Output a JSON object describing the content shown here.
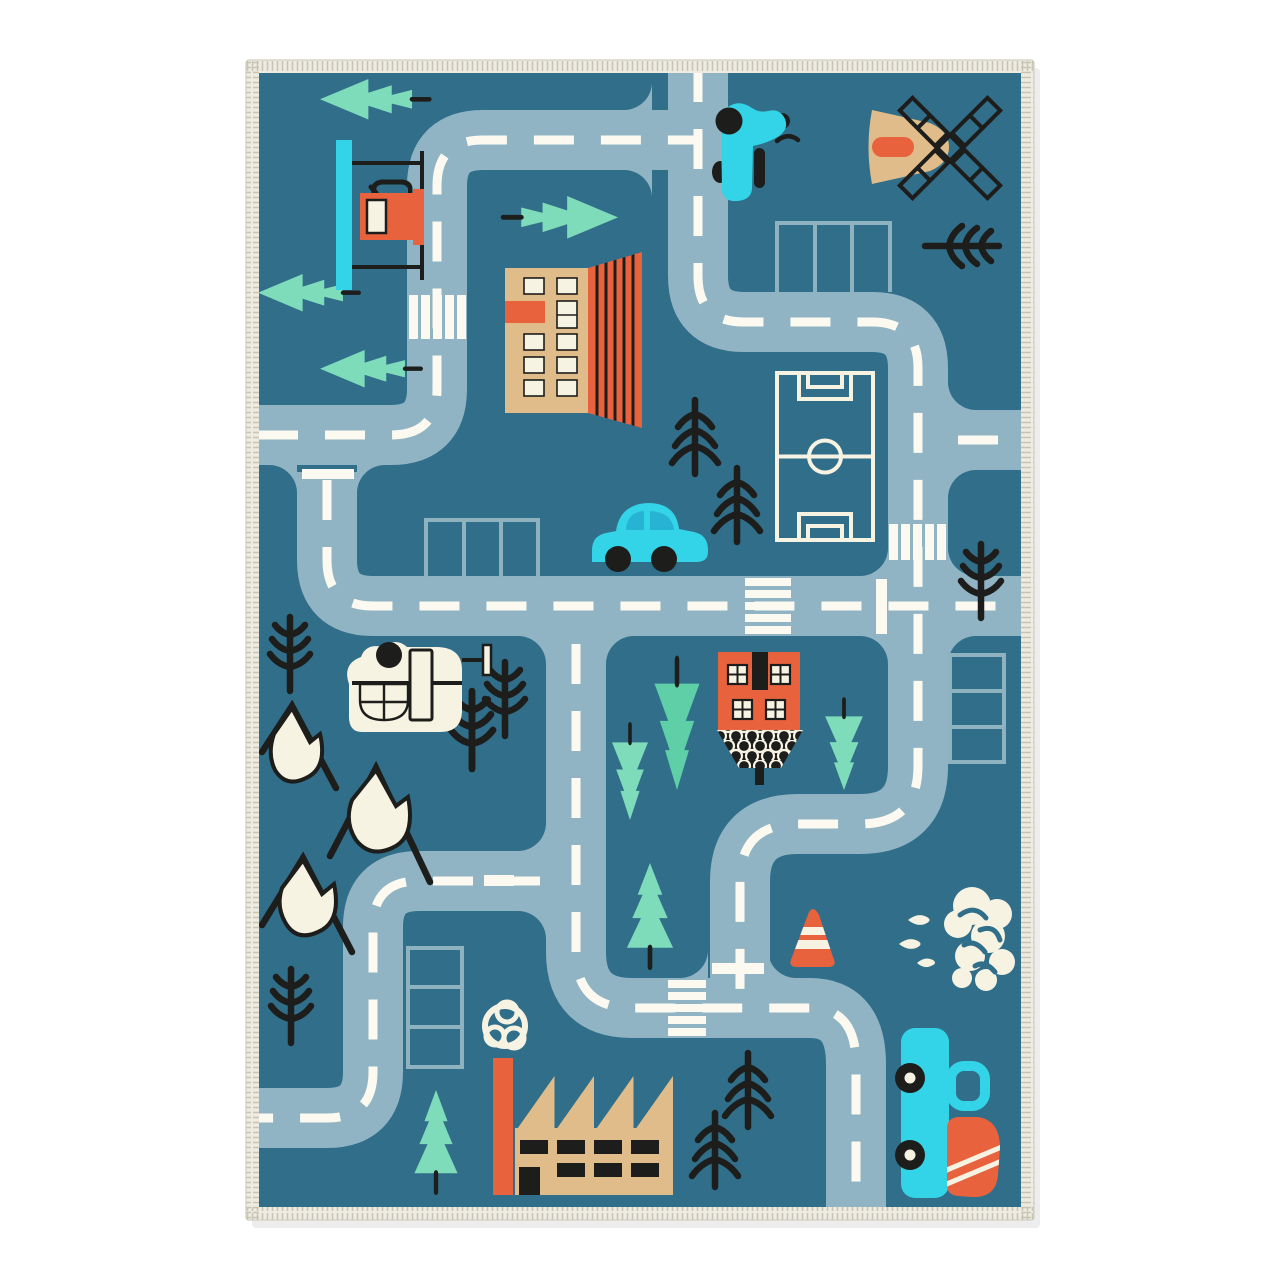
{
  "scene": {
    "description": "Children's road play rug with teal background, gray-blue roads with white dashed lines, buildings, vehicles, trees and mountains, shown on a white background with a cream fringed border",
    "type": "kids-road-play-rug",
    "objects": [
      {
        "name": "road-network",
        "count": 1
      },
      {
        "name": "crosswalk",
        "count": 4
      },
      {
        "name": "parking-lot",
        "count": 4
      },
      {
        "name": "mint-evergreen-tree",
        "count": 9
      },
      {
        "name": "black-pine-tree",
        "count": 10
      },
      {
        "name": "snow-capped-mountain",
        "count": 3
      },
      {
        "name": "gas-station",
        "count": 1
      },
      {
        "name": "apartment-building",
        "count": 1
      },
      {
        "name": "windmill",
        "count": 1
      },
      {
        "name": "scooter",
        "count": 1
      },
      {
        "name": "soccer-field",
        "count": 1
      },
      {
        "name": "blue-car",
        "count": 1
      },
      {
        "name": "helicopter",
        "count": 1
      },
      {
        "name": "house",
        "count": 1
      },
      {
        "name": "factory",
        "count": 1
      },
      {
        "name": "truck",
        "count": 1
      },
      {
        "name": "traffic-cone",
        "count": 1
      },
      {
        "name": "bush-cloud",
        "count": 1
      },
      {
        "name": "chimney-smoke",
        "count": 1
      }
    ]
  },
  "colors": {
    "page_bg": "#ffffff",
    "rug_bg": "#306e8a",
    "road": "#90b4c3",
    "road_line": "#fcfaf0",
    "parking_line": "#8fb2c1",
    "mint": "#7edcba",
    "mint_dark": "#5ecfa6",
    "orange": "#e8623e",
    "tan": "#dfbc89",
    "cream": "#f7f3e3",
    "cyan": "#33d4e7",
    "cyan_deep": "#27b4d4",
    "black": "#1d1d1b",
    "fringe": "#eeece2",
    "fringe_stitch": "#c9c5b4"
  }
}
